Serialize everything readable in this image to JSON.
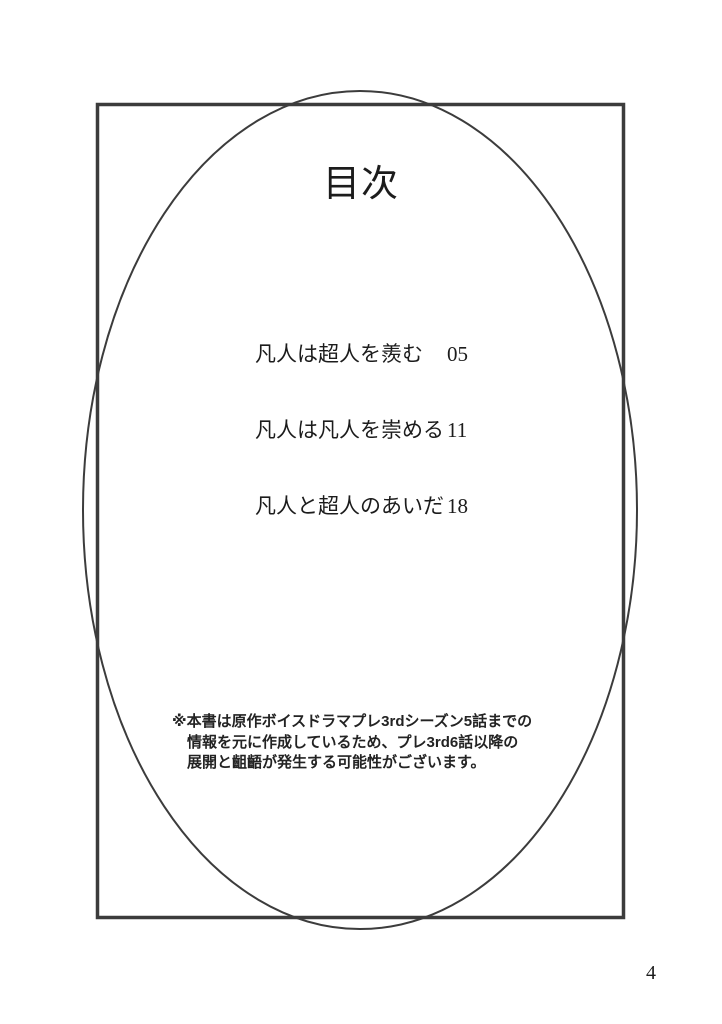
{
  "document": {
    "title": "目次",
    "page_number": "4"
  },
  "toc_entries": [
    {
      "label": "凡人は超人を羨む",
      "page": "05"
    },
    {
      "label": "凡人は凡人を崇める",
      "page": "11"
    },
    {
      "label": "凡人と超人のあいだ",
      "page": "18"
    }
  ],
  "disclaimer": {
    "line1": "※本書は原作ボイスドラマプレ3rdシーズン5話までの",
    "line2": "情報を元に作成しているため、プレ3rd6話以降の",
    "line3": "展開と齟齬が発生する可能性がございます。"
  },
  "colors": {
    "frame_stroke": "#3c3c3c",
    "text": "#1c1c1c",
    "background": "#ffffff"
  }
}
